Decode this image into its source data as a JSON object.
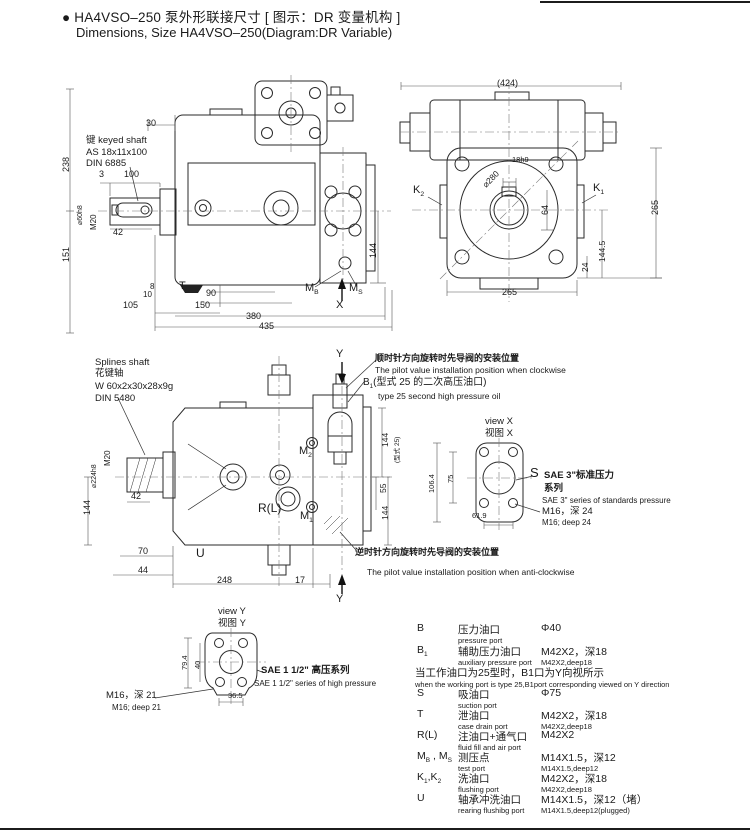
{
  "header": {
    "title_cn": "● HA4VSO–250 泵外形联接尺寸 [ 图示：DR 变量机构 ]",
    "title_en": "Dimensions, Size HA4VSO–250(Diagram:DR Variable)"
  },
  "labels": [
    {
      "n": "dim-238",
      "t": "238",
      "x": 62,
      "y": 172,
      "r": -90,
      "s": 9
    },
    {
      "n": "dim-151",
      "t": "151",
      "x": 62,
      "y": 262,
      "r": -90,
      "s": 9
    },
    {
      "n": "dim-30",
      "t": "30",
      "x": 146,
      "y": 119,
      "s": 9
    },
    {
      "n": "label-keyed-shaft",
      "t": "键 keyed shaft",
      "x": 86,
      "y": 136,
      "s": 9.5
    },
    {
      "n": "label-keyed-shaft-spec",
      "t": "AS 18x11x100",
      "x": 86,
      "y": 148,
      "s": 9.5
    },
    {
      "n": "label-keyed-shaft-din",
      "t": "DIN 6885",
      "x": 86,
      "y": 159,
      "s": 9.5
    },
    {
      "n": "dim-3",
      "t": "3",
      "x": 99,
      "y": 170,
      "s": 9
    },
    {
      "n": "dim-100",
      "t": "100",
      "x": 124,
      "y": 170,
      "s": 9
    },
    {
      "n": "dim-shaft-dia",
      "t": "⌀60h8",
      "x": 77,
      "y": 225,
      "r": -90,
      "s": 7
    },
    {
      "n": "dim-m20",
      "t": "M20",
      "x": 90,
      "y": 230,
      "r": -90,
      "s": 8
    },
    {
      "n": "dim-42",
      "t": "42",
      "x": 113,
      "y": 228,
      "s": 9
    },
    {
      "n": "dim-144-p1-right",
      "t": "144",
      "x": 369,
      "y": 258,
      "r": -90,
      "s": 9
    },
    {
      "n": "dim-8",
      "t": "8",
      "x": 150,
      "y": 283,
      "s": 8
    },
    {
      "n": "dim-10",
      "t": "10",
      "x": 143,
      "y": 291,
      "s": 8
    },
    {
      "n": "dim-105",
      "t": "105",
      "x": 123,
      "y": 301,
      "s": 9
    },
    {
      "n": "dim-90",
      "t": "90",
      "x": 206,
      "y": 289,
      "s": 9
    },
    {
      "n": "dim-150",
      "t": "150",
      "x": 195,
      "y": 301,
      "s": 9
    },
    {
      "n": "dim-380",
      "t": "380",
      "x": 246,
      "y": 312,
      "s": 9
    },
    {
      "n": "dim-435",
      "t": "435",
      "x": 259,
      "y": 322,
      "s": 9
    },
    {
      "n": "label-port-T",
      "t": "T",
      "x": 179,
      "y": 281,
      "s": 11
    },
    {
      "n": "label-port-MB",
      "p": [
        {
          "t": "M"
        },
        {
          "t": "B",
          "sub": true
        }
      ],
      "x": 305,
      "y": 283,
      "s": 11
    },
    {
      "n": "label-port-MS",
      "p": [
        {
          "t": "M"
        },
        {
          "t": "S",
          "sub": true
        }
      ],
      "x": 349,
      "y": 283,
      "s": 11
    },
    {
      "n": "label-view-x-arrow",
      "t": "X",
      "x": 336,
      "y": 300,
      "s": 11
    },
    {
      "n": "dim-424",
      "t": "(424)",
      "x": 497,
      "y": 79,
      "s": 9
    },
    {
      "n": "label-port-K2",
      "p": [
        {
          "t": "K"
        },
        {
          "t": "2",
          "sub": true
        }
      ],
      "x": 413,
      "y": 185,
      "s": 11
    },
    {
      "n": "label-port-K1",
      "p": [
        {
          "t": "K"
        },
        {
          "t": "1",
          "sub": true
        }
      ],
      "x": 593,
      "y": 183,
      "s": 11
    },
    {
      "n": "dim-280",
      "t": "⌀280",
      "x": 481,
      "y": 183,
      "r": -45,
      "s": 8.5
    },
    {
      "n": "dim-18h9",
      "t": "18h9",
      "x": 512,
      "y": 156,
      "s": 7.5
    },
    {
      "n": "dim-64",
      "t": "64",
      "x": 541,
      "y": 215,
      "r": -90,
      "s": 9
    },
    {
      "n": "dim-144-5",
      "t": "144.5",
      "x": 598,
      "y": 262,
      "r": -90,
      "s": 8.5
    },
    {
      "n": "dim-24",
      "t": "24",
      "x": 581,
      "y": 272,
      "r": -90,
      "s": 8.5
    },
    {
      "n": "dim-265-right",
      "t": "265",
      "x": 651,
      "y": 215,
      "r": -90,
      "s": 9
    },
    {
      "n": "dim-265-bottom",
      "t": "265",
      "x": 502,
      "y": 288,
      "s": 9
    },
    {
      "n": "label-splines-shaft-en",
      "t": "Splines shaft",
      "x": 95,
      "y": 358,
      "s": 9.5
    },
    {
      "n": "label-splines-shaft-cn",
      "t": "花键轴",
      "x": 95,
      "y": 369,
      "s": 9.5
    },
    {
      "n": "label-splines-shaft-spec",
      "t": "W 60x2x30x28x9g",
      "x": 95,
      "y": 382,
      "s": 9.5
    },
    {
      "n": "label-splines-shaft-din",
      "t": "DIN 5480",
      "x": 95,
      "y": 394,
      "s": 9.5
    },
    {
      "n": "dim-m20-2",
      "t": "M20",
      "x": 104,
      "y": 466,
      "r": -90,
      "s": 8
    },
    {
      "n": "dim-224",
      "t": "⌀224h8",
      "x": 91,
      "y": 488,
      "r": -90,
      "s": 7
    },
    {
      "n": "dim-144-p3-left",
      "t": "144",
      "x": 83,
      "y": 515,
      "r": -90,
      "s": 9
    },
    {
      "n": "dim-42-2",
      "t": "42",
      "x": 131,
      "y": 492,
      "s": 9
    },
    {
      "n": "dim-70",
      "t": "70",
      "x": 138,
      "y": 547,
      "s": 9
    },
    {
      "n": "dim-44",
      "t": "44",
      "x": 138,
      "y": 566,
      "s": 9
    },
    {
      "n": "dim-248",
      "t": "248",
      "x": 217,
      "y": 576,
      "s": 9
    },
    {
      "n": "dim-17",
      "t": "17",
      "x": 295,
      "y": 576,
      "s": 9
    },
    {
      "n": "label-port-U",
      "t": "U",
      "x": 196,
      "y": 547,
      "s": 12
    },
    {
      "n": "label-port-RL",
      "t": "R(L)",
      "x": 258,
      "y": 502,
      "s": 12
    },
    {
      "n": "label-port-M2",
      "p": [
        {
          "t": "M"
        },
        {
          "t": "2",
          "sub": true
        }
      ],
      "x": 299,
      "y": 446,
      "s": 11
    },
    {
      "n": "label-port-M1",
      "p": [
        {
          "t": "M"
        },
        {
          "t": "1",
          "sub": true
        }
      ],
      "x": 300,
      "y": 511,
      "s": 11
    },
    {
      "n": "label-view-y-top",
      "t": "Y",
      "x": 336,
      "y": 349,
      "s": 11
    },
    {
      "n": "label-view-y-bottom",
      "t": "Y",
      "x": 336,
      "y": 594,
      "s": 11
    },
    {
      "n": "dim-144-p3-rt",
      "t": "144",
      "x": 381,
      "y": 447,
      "r": -90,
      "s": 8.5
    },
    {
      "n": "label-type25",
      "t": "(型式 25)",
      "x": 395,
      "y": 463,
      "r": -90,
      "s": 6.5
    },
    {
      "n": "dim-55",
      "t": "55",
      "x": 379,
      "y": 493,
      "r": -90,
      "s": 8.5
    },
    {
      "n": "dim-144-p3-rb",
      "t": "144",
      "x": 381,
      "y": 520,
      "r": -90,
      "s": 8.5
    },
    {
      "n": "note-clockwise-cn",
      "t": "顺时针方向旋转时先导阀的安装位置",
      "x": 375,
      "y": 354,
      "s": 9,
      "b": true
    },
    {
      "n": "note-clockwise-en",
      "t": "The pilot value installation position when clockwise",
      "x": 375,
      "y": 366,
      "s": 8.5
    },
    {
      "n": "label-port-B1",
      "p": [
        {
          "t": "B"
        },
        {
          "t": "1",
          "sub": true
        },
        {
          "t": "(型式 25 的二次高压油口)"
        }
      ],
      "x": 363,
      "y": 378,
      "s": 10
    },
    {
      "n": "note-type25-en",
      "t": "type 25 second high pressure oil",
      "x": 378,
      "y": 392,
      "s": 8.5
    },
    {
      "n": "note-anticlockwise-cn",
      "t": "逆时针方向旋转时先导阀的安装位置",
      "x": 355,
      "y": 548,
      "s": 9,
      "b": true
    },
    {
      "n": "note-anticlockwise-en",
      "t": "The pilot value installation position when anti-clockwise",
      "x": 367,
      "y": 568,
      "s": 8.5
    },
    {
      "n": "view-x-title-en",
      "t": "view X",
      "x": 485,
      "y": 417,
      "s": 9.5
    },
    {
      "n": "view-x-title-cn",
      "t": "视图 X",
      "x": 485,
      "y": 429,
      "s": 9.5
    },
    {
      "n": "dim-106-4",
      "t": "106.4",
      "x": 428,
      "y": 493,
      "r": -90,
      "s": 7.5
    },
    {
      "n": "dim-75",
      "t": "75",
      "x": 447,
      "y": 483,
      "r": -90,
      "s": 7.5
    },
    {
      "n": "dim-61-9",
      "t": "61.9",
      "x": 472,
      "y": 512,
      "s": 7.5
    },
    {
      "n": "label-port-S",
      "t": "S",
      "x": 530,
      "y": 466,
      "s": 13
    },
    {
      "n": "label-sae3-cn1",
      "t": "SAE 3\"标准压力",
      "x": 544,
      "y": 471,
      "s": 9.5,
      "b": true
    },
    {
      "n": "label-sae3-cn2",
      "t": "系列",
      "x": 544,
      "y": 484,
      "s": 9.5,
      "b": true
    },
    {
      "n": "label-sae3-en",
      "t": "SAE 3\" series of standards pressure",
      "x": 542,
      "y": 497,
      "s": 8
    },
    {
      "n": "label-m16-24-cn",
      "t": "M16，深 24",
      "x": 542,
      "y": 507,
      "s": 9.5
    },
    {
      "n": "label-m16-24-en",
      "t": "M16; deep 24",
      "x": 542,
      "y": 519,
      "s": 8
    },
    {
      "n": "view-y-title-en",
      "t": "view Y",
      "x": 218,
      "y": 607,
      "s": 9.5
    },
    {
      "n": "view-y-title-cn",
      "t": "视图 Y",
      "x": 218,
      "y": 619,
      "s": 9.5
    },
    {
      "n": "dim-79-4",
      "t": "79.4",
      "x": 181,
      "y": 670,
      "r": -90,
      "s": 7.5
    },
    {
      "n": "dim-40",
      "t": "40",
      "x": 194,
      "y": 669,
      "r": -90,
      "s": 7.5
    },
    {
      "n": "dim-36-5",
      "t": "36.5",
      "x": 228,
      "y": 692,
      "s": 7.5
    },
    {
      "n": "label-m16-21-cn",
      "t": "M16，深 21",
      "x": 106,
      "y": 691,
      "s": 9.5
    },
    {
      "n": "label-m16-21-en",
      "t": "M16; deep 21",
      "x": 112,
      "y": 704,
      "s": 8
    },
    {
      "n": "label-sae112-cn",
      "t": "SAE 1 1/2\" 高压系列",
      "x": 261,
      "y": 666,
      "s": 9.5,
      "b": true
    },
    {
      "n": "label-sae112-en",
      "t": "SAE 1 1/2\" series of high pressure",
      "x": 254,
      "y": 680,
      "s": 8
    }
  ],
  "table": {
    "rows": [
      {
        "id": "B",
        "y": 622,
        "code": [
          {
            "t": "B"
          }
        ],
        "cn": "压力油口",
        "en": "pressure port",
        "val": "Φ40",
        "val_sub": ""
      },
      {
        "id": "B1",
        "y": 644,
        "code": [
          {
            "t": "B"
          },
          {
            "t": "1",
            "sub": true
          }
        ],
        "cn": "辅助压力油口",
        "en": "auxiliary pressure port",
        "val": "M42X2，深18",
        "val_sub": "M42X2,deep18"
      },
      {
        "y": 665,
        "note_cn": "当工作油口为25型时，B1口为Y向视所示",
        "note_en": "when the working port is type 25,B1port corresponding viewed on Y direction"
      },
      {
        "id": "S",
        "y": 687,
        "code": [
          {
            "t": "S"
          }
        ],
        "cn": "吸油口",
        "en": "suction port",
        "val": "Φ75",
        "val_sub": ""
      },
      {
        "id": "T",
        "y": 708,
        "code": [
          {
            "t": "T"
          }
        ],
        "cn": "泄油口",
        "en": "case drain port",
        "val": "M42X2，深18",
        "val_sub": "M42X2,deep18"
      },
      {
        "id": "RL",
        "y": 729,
        "code": [
          {
            "t": "R(L)"
          }
        ],
        "cn": "注油口+通气口",
        "en": "fluid fill and air port",
        "val": "M42X2",
        "val_sub": ""
      },
      {
        "id": "MBMS",
        "y": 750,
        "code": [
          {
            "t": "M"
          },
          {
            "t": "B",
            "sub": true
          },
          {
            "t": " , M"
          },
          {
            "t": "S",
            "sub": true
          }
        ],
        "cn": "测压点",
        "en": "test port",
        "val": "M14X1.5，深12",
        "val_sub": "M14X1.5,deep12"
      },
      {
        "id": "K1K2",
        "y": 771,
        "code": [
          {
            "t": "K"
          },
          {
            "t": "1",
            "sub": true
          },
          {
            "t": ",K"
          },
          {
            "t": "2",
            "sub": true
          }
        ],
        "cn": "洗油口",
        "en": "flushing port",
        "val": "M42X2，深18",
        "val_sub": "M42X2,deep18"
      },
      {
        "id": "U",
        "y": 792,
        "code": [
          {
            "t": "U"
          }
        ],
        "cn": "轴承冲洗油口",
        "en": "rearing flushibg port",
        "val": "M14X1.5，深12（堵）",
        "val_sub": "M14X1.5,deep12(plugged)"
      }
    ]
  }
}
